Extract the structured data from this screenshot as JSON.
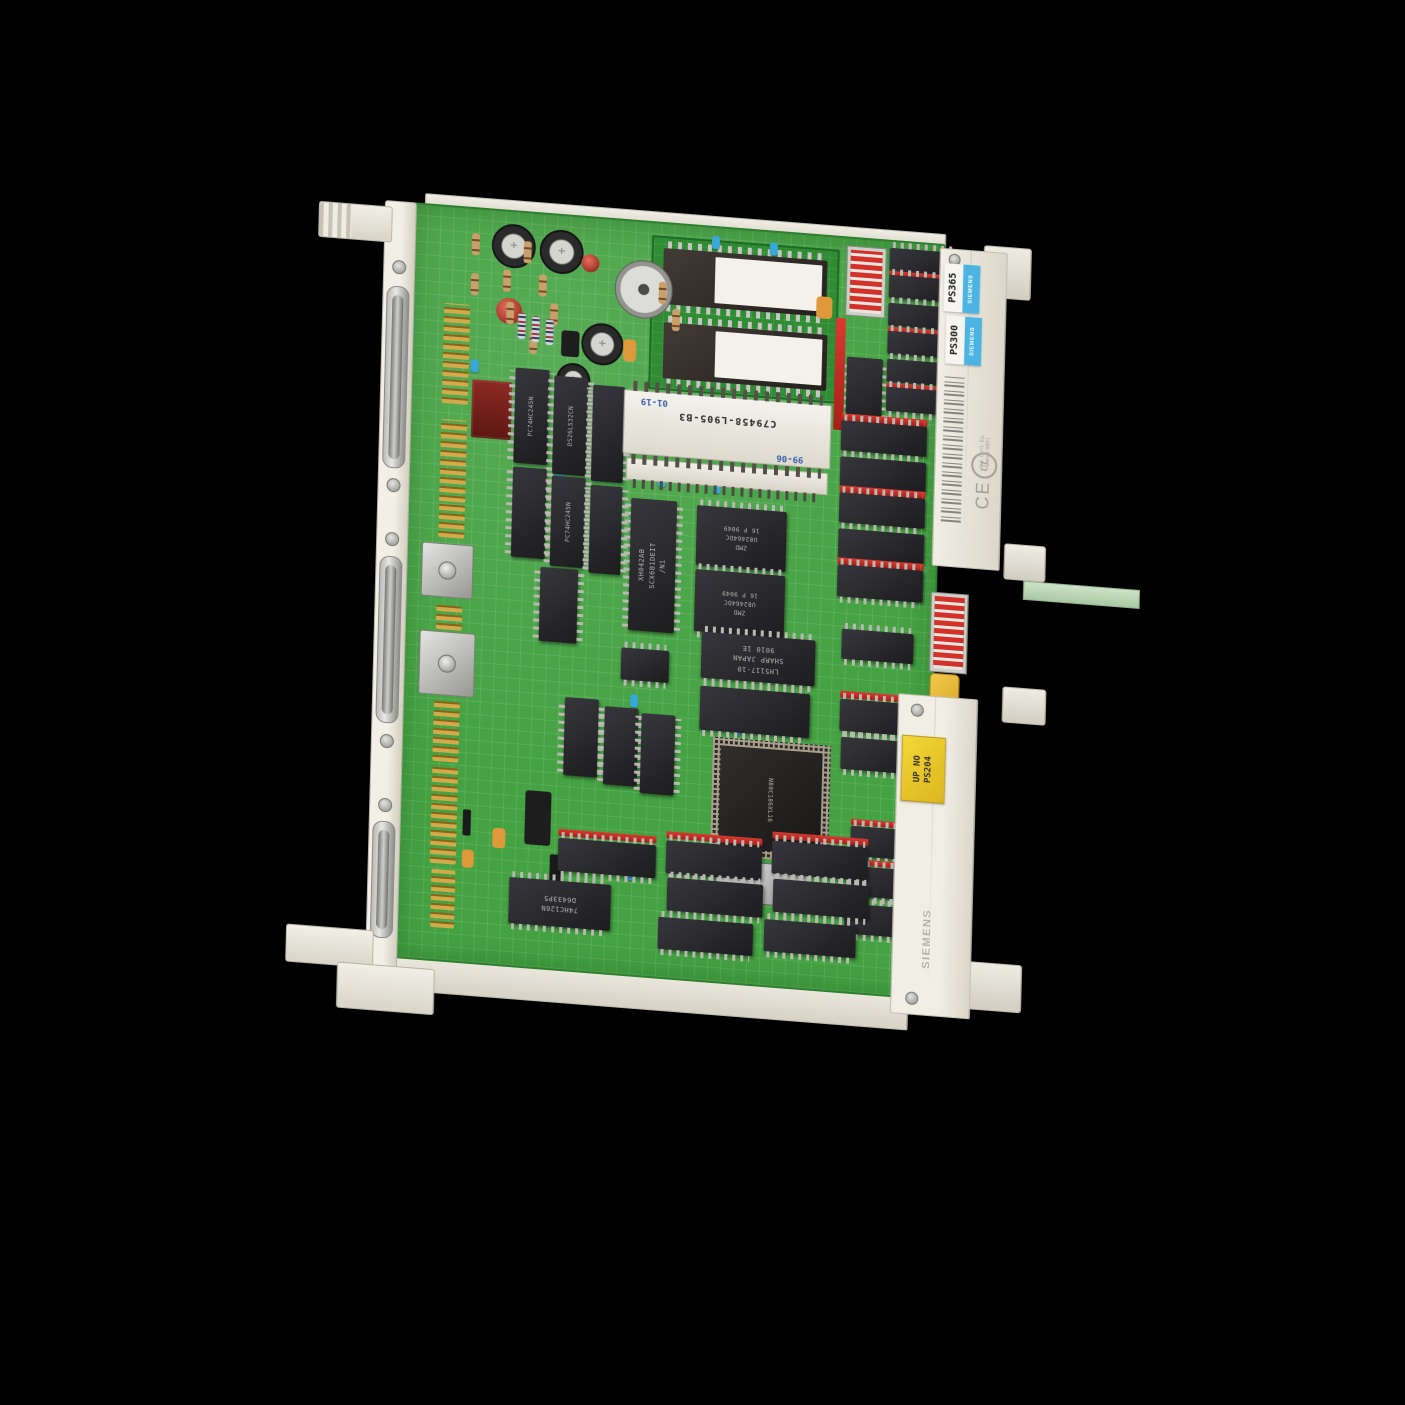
{
  "labels": {
    "product_labels": [
      {
        "model": "PS365",
        "brand": "SIEMENS"
      },
      {
        "model": "PS300",
        "brand": "SIEMENS"
      }
    ],
    "yellow_label": {
      "line1": "UP NO",
      "line2": "PS204"
    },
    "sticker_code": "C79458-L905-B3",
    "date_codes": [
      "01-19",
      "99-06"
    ],
    "cert": {
      "ce": "CE",
      "ul": "UL",
      "line1": "Ind. Cont. Eq.",
      "line2": "Listed 9B01"
    },
    "embossed_brand": "SIEMENS"
  },
  "markings": {
    "xh042": "XH042AB\nSCX6B1DEIT\n/N1",
    "zmd": "ZMD\nU82464DC\n16 P 9049",
    "sharp": "LH5117-10\nSHARP JAPAN\n9010 1E",
    "cpu": "N80C186XL16",
    "hc126": "74HC126N\nD6433P5",
    "hc245": "PC74HC245N",
    "ls32": "DS26LS32CN"
  },
  "colors": {
    "pcb_green": "#44a242",
    "daughter_green": "#2f8c33",
    "rail_cream": "#f0ede4",
    "label_blue": "#4cb4e2",
    "label_yellow": "#e8c92c",
    "socket_red": "#c52822",
    "gold_pins": "#d2aa4a",
    "background": "#000000"
  },
  "components": [
    {
      "t": "pins",
      "x": 32,
      "y": 96,
      "w": 26,
      "h": 100
    },
    {
      "t": "pins",
      "x": 32,
      "y": 212,
      "w": 26,
      "h": 118
    },
    {
      "t": "pins",
      "x": 32,
      "y": 398,
      "w": 26,
      "h": 24
    },
    {
      "t": "pins",
      "x": 32,
      "y": 492,
      "w": 26,
      "h": 62
    },
    {
      "t": "pins",
      "x": 32,
      "y": 560,
      "w": 26,
      "h": 96
    },
    {
      "t": "pins",
      "x": 34,
      "y": 662,
      "w": 24,
      "h": 58
    },
    {
      "t": "shield",
      "x": 16,
      "y": 336,
      "w": 52,
      "h": 54
    },
    {
      "t": "shield",
      "x": 16,
      "y": 424,
      "w": 56,
      "h": 64
    },
    {
      "t": "cap-el",
      "x": 78,
      "y": 12,
      "w": 44
    },
    {
      "t": "cap-el",
      "x": 126,
      "y": 14,
      "w": 44
    },
    {
      "t": "cap-el",
      "x": 170,
      "y": 104,
      "w": 42
    },
    {
      "t": "cap-el",
      "x": 146,
      "y": 146,
      "w": 34
    },
    {
      "t": "trimmer",
      "x": 202,
      "y": 38,
      "w": 58
    },
    {
      "t": "cap-disc",
      "x": 84,
      "y": 86,
      "w": 26
    },
    {
      "t": "cap-disc",
      "x": 168,
      "y": 36,
      "w": 18
    },
    {
      "t": "res",
      "x": 58,
      "y": 24,
      "w": 8,
      "h": 22
    },
    {
      "t": "res",
      "x": 90,
      "y": 58,
      "w": 8,
      "h": 22
    },
    {
      "t": "res",
      "x": 110,
      "y": 28,
      "w": 8,
      "h": 22
    },
    {
      "t": "res",
      "x": 126,
      "y": 60,
      "w": 8,
      "h": 22
    },
    {
      "t": "res",
      "x": 58,
      "y": 64,
      "w": 8,
      "h": 22
    },
    {
      "t": "res",
      "x": 138,
      "y": 88,
      "w": 8,
      "h": 22
    },
    {
      "t": "res",
      "x": 94,
      "y": 90,
      "w": 8,
      "h": 22
    },
    {
      "t": "res",
      "x": 246,
      "y": 58,
      "w": 8,
      "h": 22
    },
    {
      "t": "res",
      "x": 260,
      "y": 84,
      "w": 8,
      "h": 22
    },
    {
      "t": "res",
      "x": 118,
      "y": 116,
      "w": 8,
      "h": 24
    },
    {
      "t": "res2",
      "x": 106,
      "y": 100,
      "w": 8,
      "h": 26
    },
    {
      "t": "res2",
      "x": 120,
      "y": 102,
      "w": 8,
      "h": 26
    },
    {
      "t": "res2",
      "x": 134,
      "y": 104,
      "w": 8,
      "h": 26
    },
    {
      "t": "cap-tan",
      "x": 212,
      "y": 118,
      "w": 13,
      "h": 22
    },
    {
      "t": "cap-tan",
      "x": 404,
      "y": 60,
      "w": 16,
      "h": 22
    },
    {
      "t": "cap-tan",
      "x": 94,
      "y": 616,
      "w": 13,
      "h": 20
    },
    {
      "t": "cap-tan",
      "x": 64,
      "y": 640,
      "w": 12,
      "h": 18
    },
    {
      "t": "cap-yel",
      "x": 527,
      "y": 427,
      "w": 30,
      "h": 46
    },
    {
      "t": "cap-blu",
      "x": 298,
      "y": 8,
      "w": 8,
      "h": 13
    },
    {
      "t": "cap-blu",
      "x": 356,
      "y": 10,
      "w": 8,
      "h": 13
    },
    {
      "t": "cap-blu",
      "x": 148,
      "y": 252,
      "w": 8,
      "h": 13
    },
    {
      "t": "cap-blu",
      "x": 250,
      "y": 250,
      "w": 8,
      "h": 13
    },
    {
      "t": "cap-blu",
      "x": 305,
      "y": 252,
      "w": 8,
      "h": 13
    },
    {
      "t": "cap-blu",
      "x": 60,
      "y": 150,
      "w": 8,
      "h": 13
    },
    {
      "t": "cap-blu",
      "x": 440,
      "y": 238,
      "w": 8,
      "h": 13
    },
    {
      "t": "cap-blu",
      "x": 228,
      "y": 472,
      "w": 8,
      "h": 13
    },
    {
      "t": "cap-blu",
      "x": 332,
      "y": 492,
      "w": 8,
      "h": 13
    },
    {
      "t": "cap-blu",
      "x": 300,
      "y": 475,
      "w": 8,
      "h": 13
    },
    {
      "t": "cap-blu",
      "x": 408,
      "y": 592,
      "w": 8,
      "h": 13
    },
    {
      "t": "cap-blu",
      "x": 230,
      "y": 645,
      "w": 8,
      "h": 13
    },
    {
      "t": "tr",
      "x": 150,
      "y": 114,
      "w": 18,
      "h": 26
    },
    {
      "t": "tr",
      "x": 126,
      "y": 576,
      "w": 26,
      "h": 54
    },
    {
      "t": "diode",
      "x": 152,
      "y": 638,
      "w": 12,
      "h": 30
    },
    {
      "t": "diode",
      "x": 64,
      "y": 600,
      "w": 8,
      "h": 26
    },
    {
      "t": "resnet",
      "x": 62,
      "y": 170,
      "w": 40,
      "h": 58
    },
    {
      "t": "chip-v",
      "x": 105,
      "y": 155,
      "w": 34,
      "h": 95,
      "m": "hc245"
    },
    {
      "t": "chip-v",
      "x": 144,
      "y": 160,
      "w": 34,
      "h": 98,
      "m": "ls32"
    },
    {
      "t": "chip-v",
      "x": 183,
      "y": 166,
      "w": 32,
      "h": 96
    },
    {
      "t": "chip-v",
      "x": 105,
      "y": 254,
      "w": 34,
      "h": 90
    },
    {
      "t": "chip-v",
      "x": 144,
      "y": 260,
      "w": 34,
      "h": 90,
      "m": "hc245"
    },
    {
      "t": "chip-v",
      "x": 183,
      "y": 266,
      "w": 32,
      "h": 88
    },
    {
      "t": "chip-v",
      "x": 135,
      "y": 352,
      "w": 38,
      "h": 74
    },
    {
      "t": "chip-v",
      "x": 163,
      "y": 480,
      "w": 34,
      "h": 78
    },
    {
      "t": "chip-v",
      "x": 203,
      "y": 486,
      "w": 34,
      "h": 78
    },
    {
      "t": "chip-v",
      "x": 240,
      "y": 490,
      "w": 34,
      "h": 80
    },
    {
      "t": "chip-v",
      "x": 436,
      "y": 118,
      "w": 36,
      "h": 70
    },
    {
      "t": "chip-h",
      "x": 218,
      "y": 426,
      "w": 48,
      "h": 32
    },
    {
      "t": "chip-v big",
      "x": 224,
      "y": 276,
      "w": 46,
      "h": 132,
      "m": "xh042"
    },
    {
      "t": "chip-h",
      "x": 290,
      "y": 278,
      "w": 90,
      "h": 60,
      "m": "zmd"
    },
    {
      "t": "chip-h",
      "x": 290,
      "y": 342,
      "w": 90,
      "h": 62,
      "m": "zmd"
    },
    {
      "t": "chip-h big",
      "x": 298,
      "y": 404,
      "w": 114,
      "h": 46,
      "m": "sharp"
    },
    {
      "t": "chip-h",
      "x": 298,
      "y": 458,
      "w": 110,
      "h": 44
    },
    {
      "t": "qfp",
      "x": 312,
      "y": 508,
      "w": 118,
      "h": 118,
      "m": "cpu"
    },
    {
      "t": "crystal",
      "x": 318,
      "y": 630,
      "w": 92,
      "h": 42
    },
    {
      "t": "sock-v",
      "x": 424,
      "y": 80,
      "w": 10,
      "h": 112
    },
    {
      "t": "sock-h",
      "x": 432,
      "y": 175,
      "w": 86,
      "h": 7
    },
    {
      "t": "chip-h",
      "x": 432,
      "y": 182,
      "w": 86,
      "h": 30
    },
    {
      "t": "chip-h",
      "x": 432,
      "y": 218,
      "w": 86,
      "h": 30
    },
    {
      "t": "sock-h",
      "x": 432,
      "y": 247,
      "w": 86,
      "h": 7
    },
    {
      "t": "chip-h",
      "x": 432,
      "y": 254,
      "w": 86,
      "h": 30
    },
    {
      "t": "chip-h",
      "x": 432,
      "y": 290,
      "w": 86,
      "h": 30
    },
    {
      "t": "sock-h",
      "x": 432,
      "y": 319,
      "w": 86,
      "h": 7
    },
    {
      "t": "chip-h",
      "x": 432,
      "y": 326,
      "w": 86,
      "h": 32
    },
    {
      "t": "chip-h",
      "x": 438,
      "y": 390,
      "w": 72,
      "h": 30
    },
    {
      "t": "dipswitch",
      "x": 434,
      "y": 8,
      "w": 38,
      "h": 68
    },
    {
      "t": "chip-h",
      "x": 476,
      "y": 6,
      "w": 70,
      "h": 23
    },
    {
      "t": "sock-h",
      "x": 476,
      "y": 29,
      "w": 70,
      "h": 6
    },
    {
      "t": "chip-h",
      "x": 476,
      "y": 33,
      "w": 70,
      "h": 23
    },
    {
      "t": "chip-h",
      "x": 476,
      "y": 61,
      "w": 70,
      "h": 23
    },
    {
      "t": "sock-h",
      "x": 476,
      "y": 85,
      "w": 70,
      "h": 6
    },
    {
      "t": "chip-h",
      "x": 476,
      "y": 89,
      "w": 70,
      "h": 23
    },
    {
      "t": "chip-h",
      "x": 476,
      "y": 117,
      "w": 70,
      "h": 23
    },
    {
      "t": "sock-h",
      "x": 476,
      "y": 141,
      "w": 70,
      "h": 6
    },
    {
      "t": "chip-h",
      "x": 476,
      "y": 145,
      "w": 70,
      "h": 24
    },
    {
      "t": "dipswitch",
      "x": 527,
      "y": 347,
      "w": 36,
      "h": 78
    },
    {
      "t": "sock-h",
      "x": 438,
      "y": 452,
      "w": 76,
      "h": 7
    },
    {
      "t": "chip-h",
      "x": 438,
      "y": 460,
      "w": 76,
      "h": 32
    },
    {
      "t": "chip-h",
      "x": 440,
      "y": 498,
      "w": 76,
      "h": 32
    },
    {
      "t": "sock-h",
      "x": 452,
      "y": 579,
      "w": 70,
      "h": 6
    },
    {
      "t": "chip-h",
      "x": 452,
      "y": 586,
      "w": 70,
      "h": 30
    },
    {
      "t": "sock-h",
      "x": 450,
      "y": 619,
      "w": 70,
      "h": 6
    },
    {
      "t": "chip-h",
      "x": 450,
      "y": 626,
      "w": 70,
      "h": 30
    },
    {
      "t": "chip-h",
      "x": 448,
      "y": 664,
      "w": 70,
      "h": 30
    },
    {
      "t": "sock-h",
      "x": 160,
      "y": 612,
      "w": 98,
      "h": 7
    },
    {
      "t": "chip-h",
      "x": 160,
      "y": 621,
      "w": 98,
      "h": 33
    },
    {
      "t": "sock-h",
      "x": 268,
      "y": 606,
      "w": 96,
      "h": 7
    },
    {
      "t": "chip-h",
      "x": 268,
      "y": 615,
      "w": 96,
      "h": 33
    },
    {
      "t": "sock-h",
      "x": 374,
      "y": 598,
      "w": 96,
      "h": 7
    },
    {
      "t": "chip-h",
      "x": 374,
      "y": 607,
      "w": 96,
      "h": 33
    },
    {
      "t": "chip-h",
      "x": 270,
      "y": 652,
      "w": 96,
      "h": 33
    },
    {
      "t": "chip-h",
      "x": 376,
      "y": 645,
      "w": 96,
      "h": 33
    },
    {
      "t": "chip-h big",
      "x": 112,
      "y": 664,
      "w": 102,
      "h": 46,
      "m": "hc126"
    },
    {
      "t": "chip-h",
      "x": 262,
      "y": 692,
      "w": 95,
      "h": 32
    },
    {
      "t": "chip-h",
      "x": 368,
      "y": 686,
      "w": 92,
      "h": 32
    }
  ]
}
